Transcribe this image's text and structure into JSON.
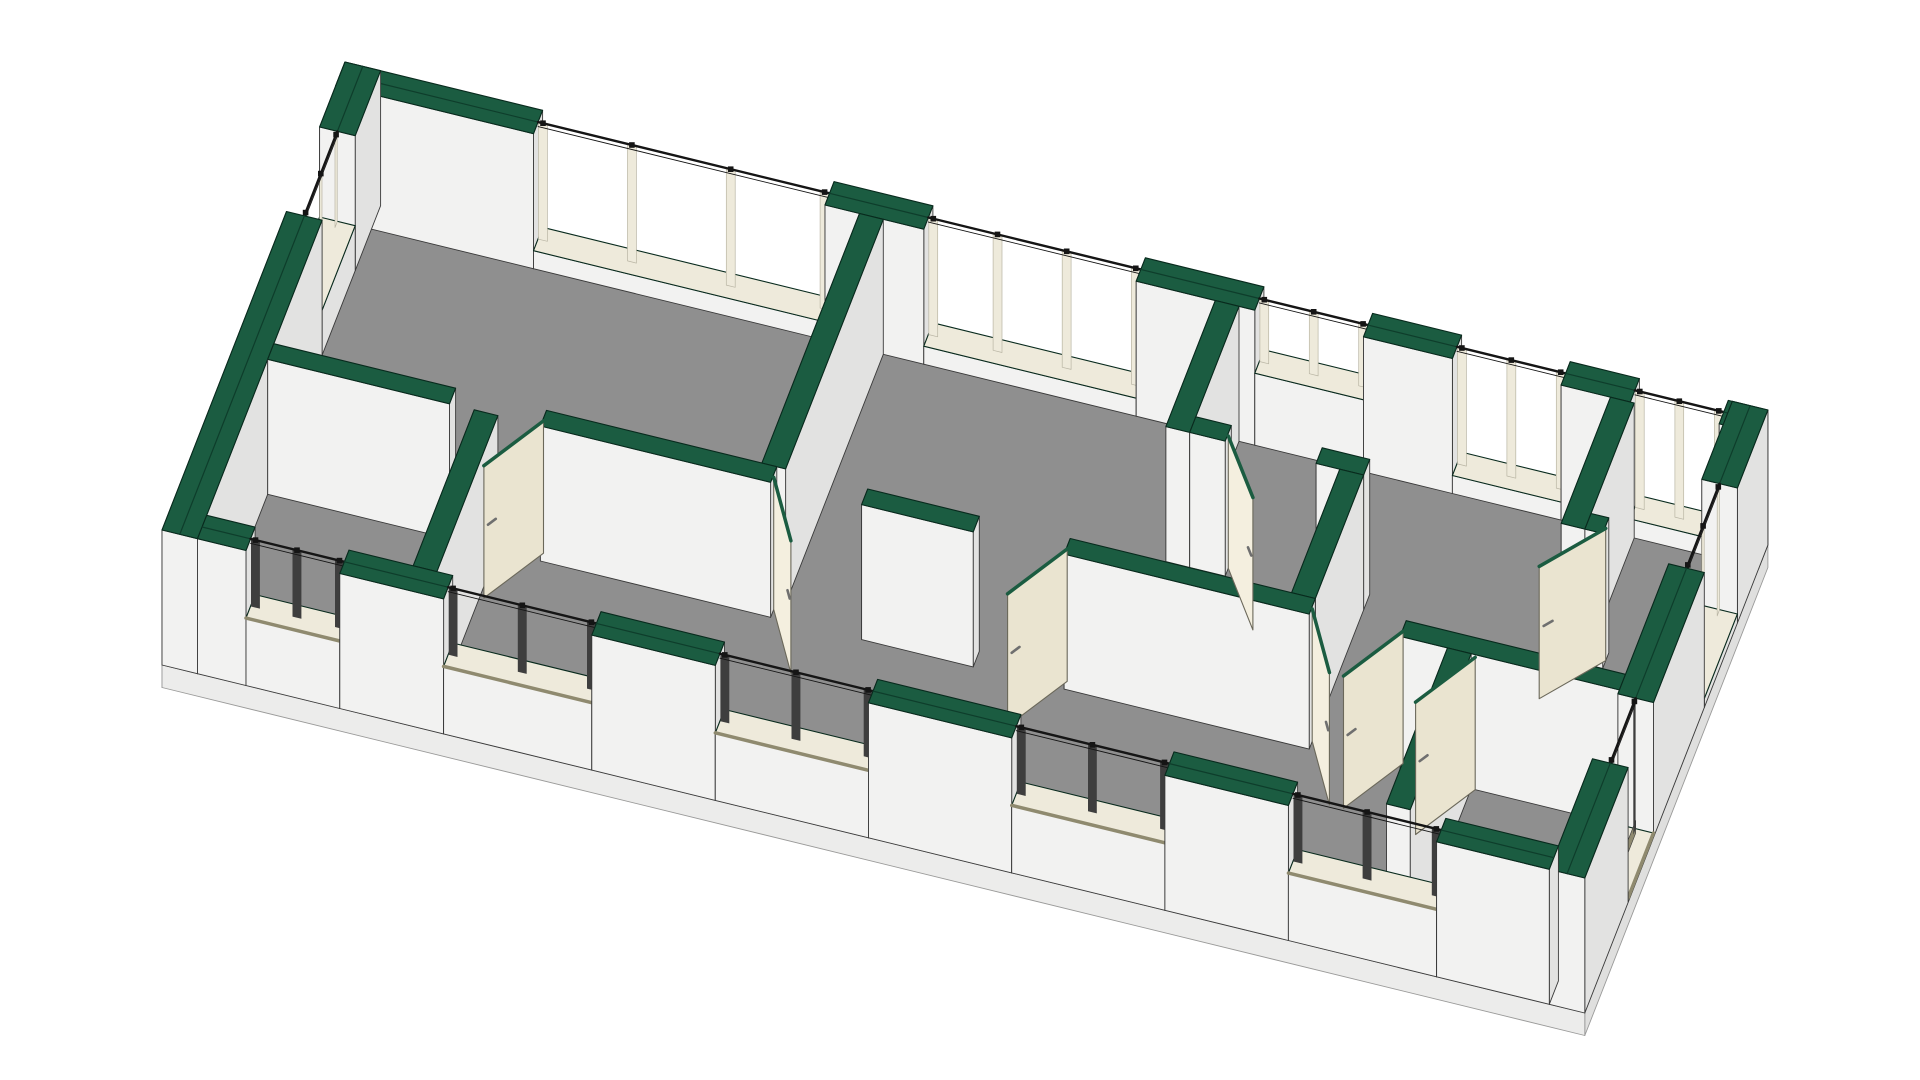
{
  "scene": {
    "label": "3D cutaway axonometric view of a single-storey floor plan",
    "background": "#ffffff",
    "canvas": {
      "width": 1920,
      "height": 1080
    }
  },
  "colors": {
    "cap_top": "#1b5c41",
    "cap_side": "#0e3d2b",
    "cap_stroke": "#082a1d",
    "wall_front": "#f2f2f1",
    "wall_side": "#e2e2e1",
    "wall_left": "#ebebea",
    "floor": "#8f8f8f",
    "slab_front": "#ececeb",
    "slab_side": "#dfdfde",
    "slab_stroke": "#9a9a99",
    "door_face": "#f4efdf",
    "door_shade": "#eae4d0",
    "door_stroke": "#6b685a",
    "handle": "#6f6f6f",
    "frame_cream": "#eeeadb",
    "frame_dark": "#3e3e3e",
    "sill_tan": "#8f8a6f",
    "cut_line": "#151515",
    "outline": "#3a3a3a"
  },
  "projection": {
    "origin": [
      345,
      197
    ],
    "ux": [
      98.81,
      24.17
    ],
    "uy": [
      -25.42,
      65.0
    ],
    "uz_y": -90,
    "cut": 1.5,
    "door_top": 1.47,
    "slab": 0.25
  },
  "plan": {
    "length": 14.4,
    "depth": 7.2,
    "ext_t": 0.36,
    "int_t": 0.24
  },
  "walls": {
    "back": {
      "axis": "x",
      "lo": 0,
      "hi": 0.36,
      "name": "exterior-wall-back",
      "segments": [
        {
          "type": "solid",
          "from": 0,
          "to": 2.0
        },
        {
          "type": "window",
          "from": 2.0,
          "to": 4.95,
          "sill": 0.2,
          "mullions": [
            2.95,
            3.95
          ],
          "style": "cream"
        },
        {
          "type": "solid",
          "from": 4.95,
          "to": 5.95
        },
        {
          "type": "window",
          "from": 5.95,
          "to": 8.1,
          "sill": 0.2,
          "mullions": [
            6.65,
            7.35
          ],
          "style": "cream"
        },
        {
          "type": "solid",
          "from": 8.1,
          "to": 9.3
        },
        {
          "type": "window",
          "from": 9.3,
          "to": 10.4,
          "sill": 0.8,
          "mullions": [
            9.85
          ],
          "style": "cream"
        },
        {
          "type": "solid",
          "from": 10.4,
          "to": 11.3
        },
        {
          "type": "window",
          "from": 11.3,
          "to": 12.4,
          "sill": 0.2,
          "mullions": [
            11.85
          ],
          "style": "cream"
        },
        {
          "type": "solid",
          "from": 12.4,
          "to": 13.1
        },
        {
          "type": "window",
          "from": 13.1,
          "to": 14.0,
          "sill": 0.2,
          "mullions": [
            13.55
          ],
          "style": "cream"
        },
        {
          "type": "solid",
          "from": 14.0,
          "to": 14.4
        }
      ]
    },
    "left": {
      "axis": "y",
      "lo": 0,
      "hi": 0.36,
      "name": "exterior-wall-left-gable",
      "segments": [
        {
          "type": "solid",
          "from": 0,
          "to": 1.0
        },
        {
          "type": "window",
          "from": 1.0,
          "to": 2.3,
          "sill": 0.5,
          "mullions": [
            1.65
          ],
          "style": "cream"
        },
        {
          "type": "solid",
          "from": 2.3,
          "to": 7.2
        }
      ]
    },
    "right": {
      "axis": "y",
      "lo": 14.04,
      "hi": 14.4,
      "name": "exterior-wall-right-gable",
      "segments": [
        {
          "type": "solid",
          "from": 0,
          "to": 1.2
        },
        {
          "type": "window",
          "from": 1.2,
          "to": 2.5,
          "sill": 0.1,
          "mullions": [
            1.85
          ],
          "style": "cream"
        },
        {
          "type": "solid",
          "from": 2.5,
          "to": 4.5
        },
        {
          "type": "window",
          "from": 4.5,
          "to": 5.5,
          "sill": 0.05,
          "mullions": [],
          "style": "dark",
          "threshold": true
        },
        {
          "type": "solid",
          "from": 5.5,
          "to": 7.2
        }
      ]
    },
    "front": {
      "axis": "x",
      "lo": 6.84,
      "hi": 7.2,
      "name": "exterior-wall-front",
      "segments": [
        {
          "type": "solid",
          "from": 0.36,
          "to": 0.85
        },
        {
          "type": "window",
          "from": 0.85,
          "to": 1.8,
          "sill": 0.75,
          "mullions": [
            1.32
          ],
          "style": "dark"
        },
        {
          "type": "solid",
          "from": 1.8,
          "to": 2.85
        },
        {
          "type": "window",
          "from": 2.85,
          "to": 4.35,
          "sill": 0.75,
          "mullions": [
            3.6
          ],
          "style": "dark"
        },
        {
          "type": "solid",
          "from": 4.35,
          "to": 5.6
        },
        {
          "type": "window",
          "from": 5.6,
          "to": 7.15,
          "sill": 0.75,
          "mullions": [
            6.37
          ],
          "style": "dark"
        },
        {
          "type": "solid",
          "from": 7.15,
          "to": 8.6
        },
        {
          "type": "window",
          "from": 8.6,
          "to": 10.15,
          "sill": 0.75,
          "mullions": [
            9.37
          ],
          "style": "dark"
        },
        {
          "type": "solid",
          "from": 10.15,
          "to": 11.4
        },
        {
          "type": "window",
          "from": 11.4,
          "to": 12.9,
          "sill": 0.75,
          "mullions": [
            12.15
          ],
          "style": "dark"
        },
        {
          "type": "solid",
          "from": 12.9,
          "to": 14.04
        }
      ]
    },
    "interior": [
      {
        "rect": [
          5.3,
          0.36,
          5.54,
          4.2
        ],
        "name": "partition-living-left"
      },
      {
        "rect": [
          0.36,
          4.2,
          2.2,
          4.44
        ],
        "name": "corridor-wall-a"
      },
      {
        "rect": [
          3.12,
          4.2,
          5.45,
          4.44
        ],
        "name": "corridor-wall-b"
      },
      {
        "rect": [
          6.37,
          4.2,
          7.5,
          4.44
        ],
        "name": "corridor-wall-c"
      },
      {
        "rect": [
          8.42,
          4.2,
          10.9,
          4.44
        ],
        "name": "corridor-wall-d"
      },
      {
        "rect": [
          11.82,
          4.2,
          14.04,
          4.44
        ],
        "name": "corridor-wall-e"
      },
      {
        "rect": [
          2.45,
          4.44,
          2.69,
          6.84
        ],
        "name": "partition-front-left"
      },
      {
        "rect": [
          8.9,
          0.36,
          9.14,
          2.3
        ],
        "name": "partition-right-a"
      },
      {
        "rect": [
          9.14,
          2.06,
          9.5,
          2.3
        ],
        "name": "partition-right-b"
      },
      {
        "rect": [
          10.42,
          2.06,
          10.9,
          2.3
        ],
        "name": "partition-right-c"
      },
      {
        "rect": [
          10.66,
          2.3,
          10.9,
          4.2
        ],
        "name": "partition-right-d"
      },
      {
        "rect": [
          12.9,
          0.36,
          13.14,
          2.3
        ],
        "name": "partition-right-end-a"
      },
      {
        "rect": [
          13.14,
          2.06,
          13.32,
          2.3
        ],
        "name": "partition-right-end-b"
      },
      {
        "rect": [
          12.3,
          4.44,
          12.54,
          6.84
        ],
        "name": "partition-front-right"
      }
    ],
    "door_leaf_count": 8,
    "window_count": 13
  },
  "doors": [
    {
      "hinge": [
        3.12,
        4.32
      ],
      "angle": 115,
      "width": 0.92,
      "name": "door-leaf-1"
    },
    {
      "hinge": [
        5.45,
        4.32
      ],
      "angle": 65,
      "width": 0.92,
      "name": "door-leaf-2"
    },
    {
      "hinge": [
        8.42,
        4.32
      ],
      "angle": 115,
      "width": 0.92,
      "name": "door-leaf-3"
    },
    {
      "hinge": [
        10.9,
        4.32
      ],
      "angle": 65,
      "width": 0.92,
      "name": "door-leaf-4"
    },
    {
      "hinge": [
        11.82,
        4.32
      ],
      "angle": 115,
      "width": 0.92,
      "name": "door-leaf-5"
    },
    {
      "hinge": [
        9.5,
        2.18
      ],
      "angle": 60,
      "width": 0.9,
      "name": "door-leaf-6"
    },
    {
      "hinge": [
        13.32,
        2.18
      ],
      "angle": 122,
      "width": 0.9,
      "name": "door-leaf-7"
    },
    {
      "hinge": [
        12.58,
        4.44
      ],
      "angle": 115,
      "width": 0.92,
      "name": "door-leaf-8"
    }
  ]
}
